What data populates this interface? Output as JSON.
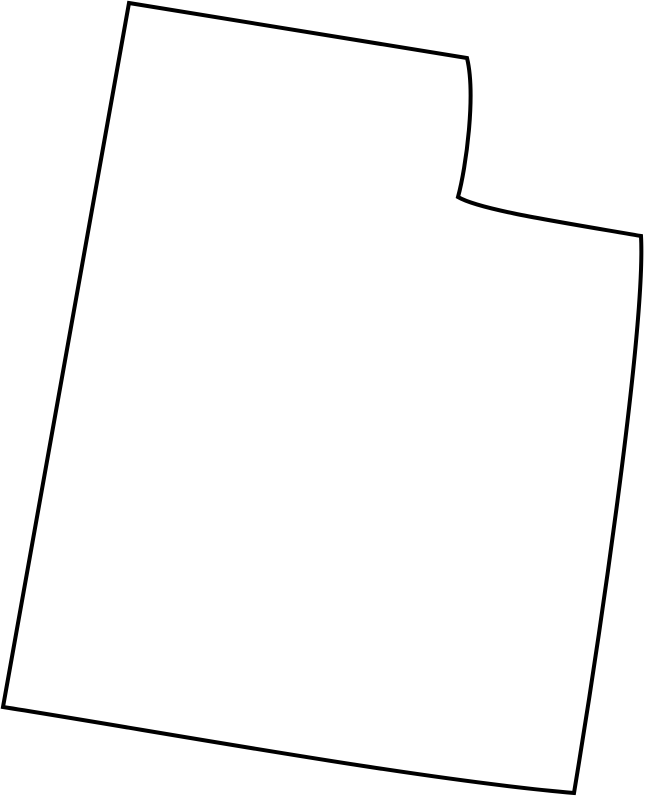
{
  "map": {
    "region_name": "Utah",
    "description": "Blank outline map of the U.S. state of Utah",
    "outline_path": "M 129,3 L 467,58 C 476,95 466,168 458,197 C 480,210 560,222 641,236 C 646,330 596,660 574,793 C 420,780 150,730 3,707 Z",
    "stroke_color": "#000000",
    "fill_color": "#ffffff",
    "stroke_width": "4",
    "background_color": "#ffffff"
  }
}
